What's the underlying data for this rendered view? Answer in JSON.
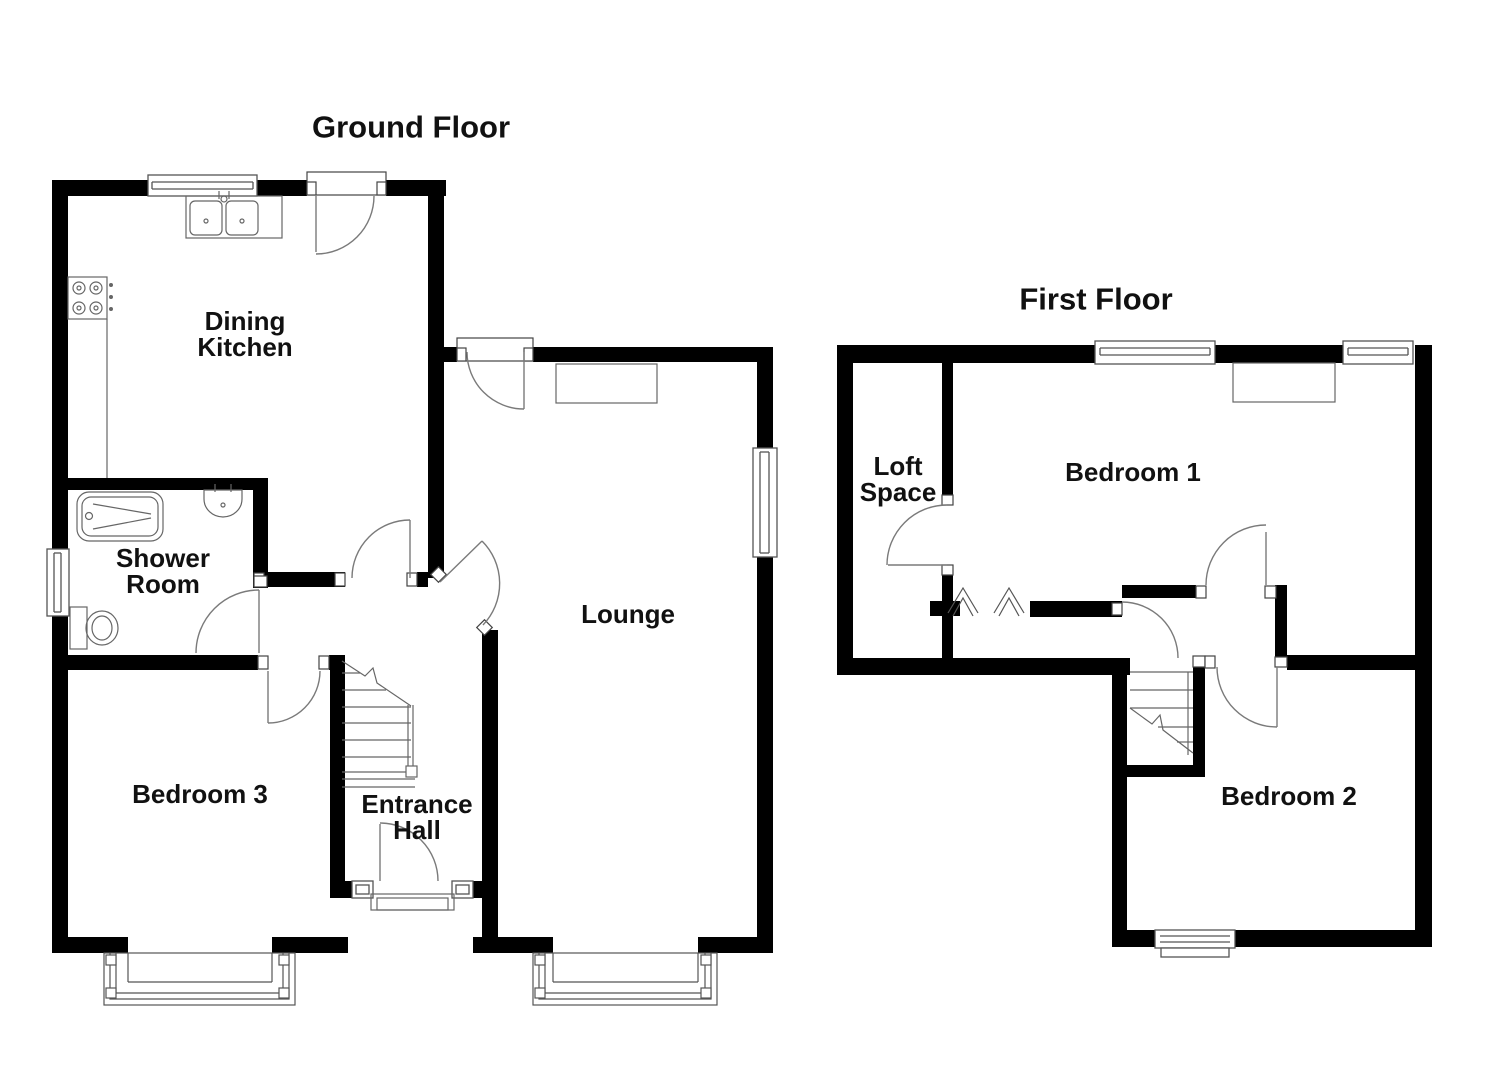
{
  "document_type": "floorplan",
  "colors": {
    "wall": "#000000",
    "fixture_line": "#6a6a6a",
    "window_line": "#555555",
    "door_arc": "#7a7a7a",
    "text": "#111111",
    "background": "#ffffff"
  },
  "ground_floor": {
    "title": "Ground Floor",
    "rooms": {
      "dining_kitchen": {
        "label": "Dining Kitchen",
        "lines": [
          "Dining",
          "Kitchen"
        ]
      },
      "shower_room": {
        "label": "Shower Room",
        "lines": [
          "Shower",
          "Room"
        ]
      },
      "lounge": {
        "label": "Lounge",
        "lines": [
          "Lounge"
        ]
      },
      "bedroom3": {
        "label": "Bedroom 3",
        "lines": [
          "Bedroom 3"
        ]
      },
      "entrance_hall": {
        "label": "Entrance Hall",
        "lines": [
          "Entrance",
          "Hall"
        ]
      }
    },
    "fixtures": [
      "kitchen-sink",
      "hob",
      "worktop",
      "bath",
      "wash-basin",
      "toilet",
      "staircase",
      "bay-window-bedroom3",
      "bay-window-lounge",
      "fireplace",
      "front-door",
      "porch-step",
      "window-kitchen",
      "window-shower-room",
      "window-lounge",
      "sidelight-left",
      "sidelight-right"
    ]
  },
  "first_floor": {
    "title": "First Floor",
    "rooms": {
      "loft_space": {
        "label": "Loft Space",
        "lines": [
          "Loft",
          "Space"
        ]
      },
      "bedroom1": {
        "label": "Bedroom 1",
        "lines": [
          "Bedroom 1"
        ]
      },
      "bedroom2": {
        "label": "Bedroom 2",
        "lines": [
          "Bedroom 2"
        ]
      }
    },
    "fixtures": [
      "staircase",
      "wardrobe",
      "eaves-chevrons",
      "window-bedroom1-left",
      "window-bedroom1-right",
      "window-bedroom2"
    ]
  }
}
